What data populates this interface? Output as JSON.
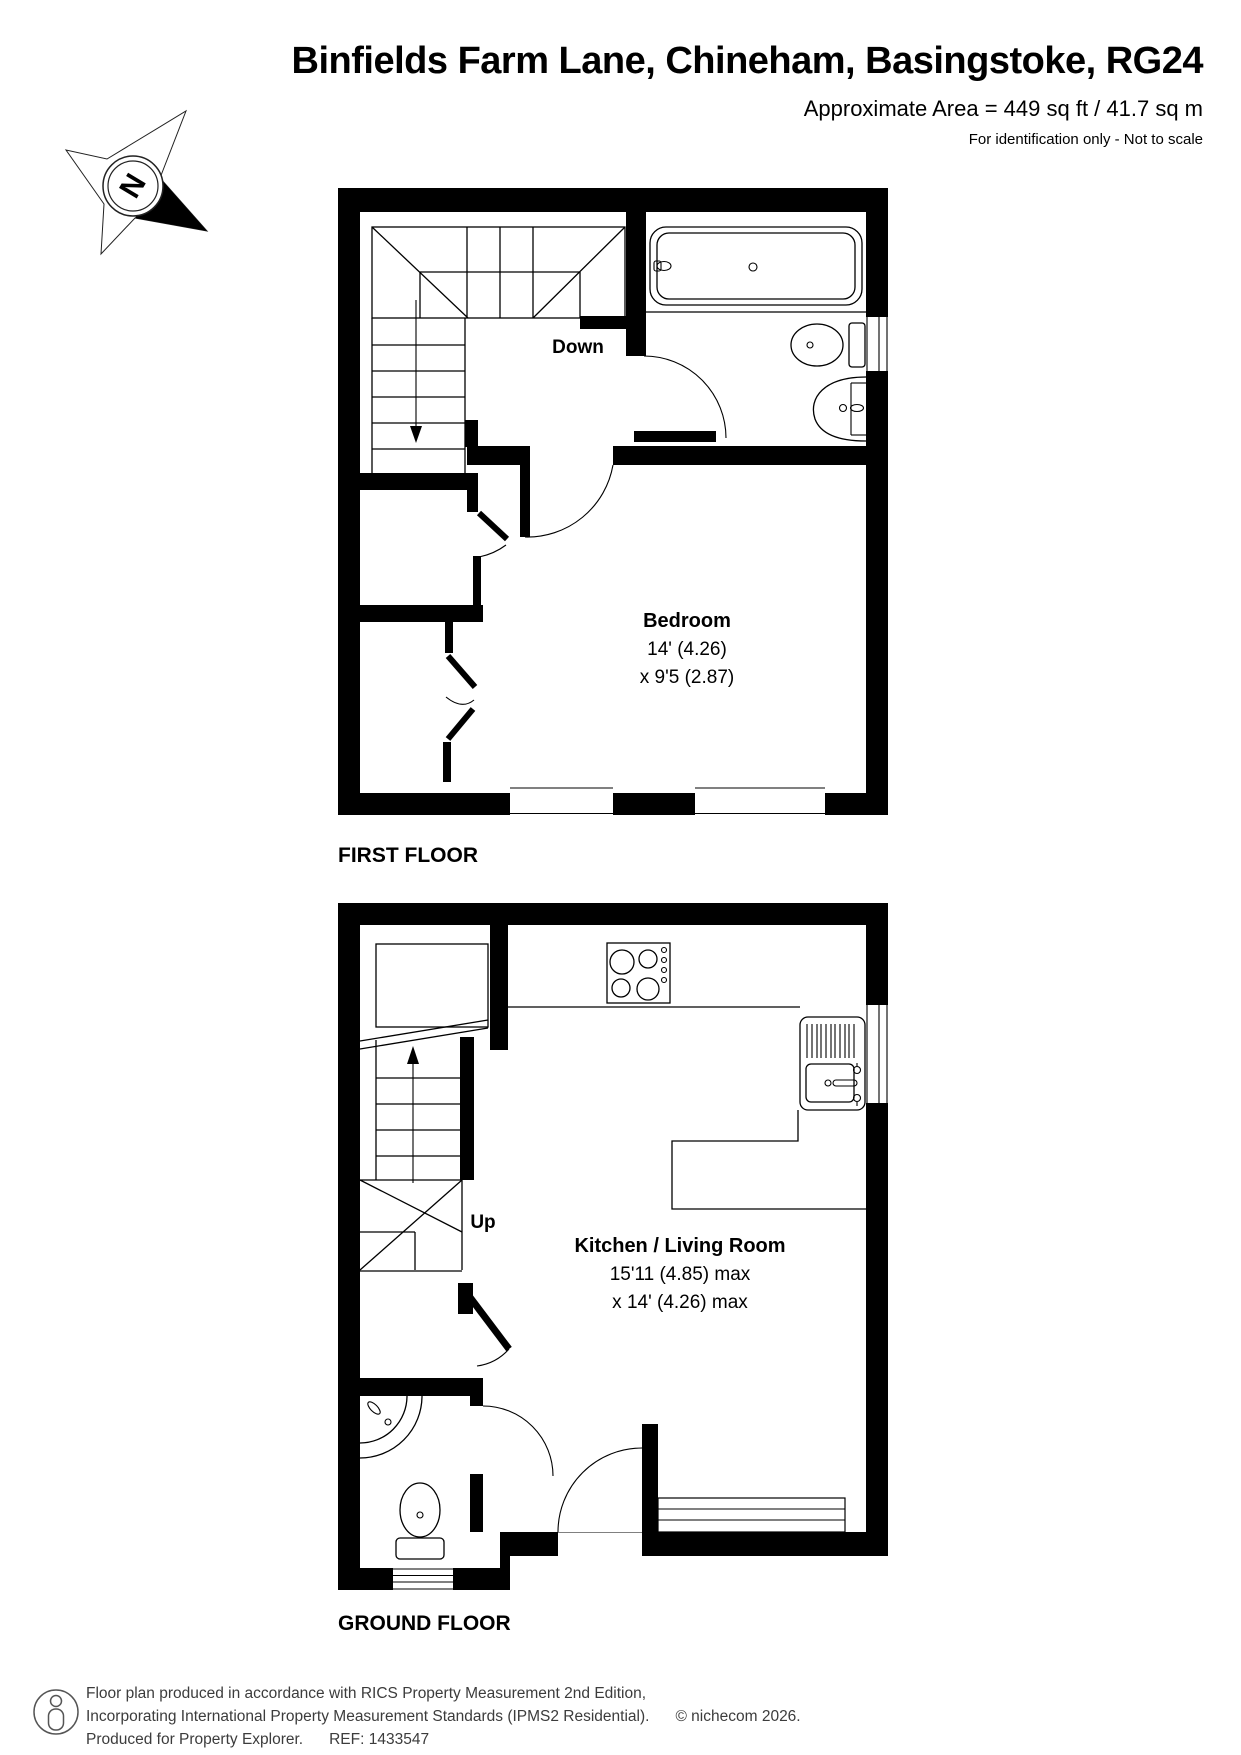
{
  "header": {
    "title": "Binfields Farm Lane, Chineham, Basingstoke, RG24",
    "area": "Approximate Area = 449 sq ft / 41.7 sq m",
    "disclaimer": "For identification only - Not to scale"
  },
  "compass": {
    "label": "N"
  },
  "first_floor": {
    "label": "FIRST FLOOR",
    "stairs_label": "Down",
    "room": {
      "name": "Bedroom",
      "dim_line1": "14' (4.26)",
      "dim_line2": "x 9'5 (2.87)"
    }
  },
  "ground_floor": {
    "label": "GROUND FLOOR",
    "stairs_label": "Up",
    "room": {
      "name": "Kitchen / Living Room",
      "dim_line1": "15'11 (4.85) max",
      "dim_line2": "x 14' (4.26) max"
    }
  },
  "footer": {
    "line1": "Floor plan produced in accordance with RICS Property Measurement 2nd Edition,",
    "line2": "Incorporating International Property Measurement Standards (IPMS2 Residential).",
    "copyright": "© nichecom 2026.",
    "line3": "Produced for Property Explorer.",
    "ref": "REF: 1433547"
  }
}
